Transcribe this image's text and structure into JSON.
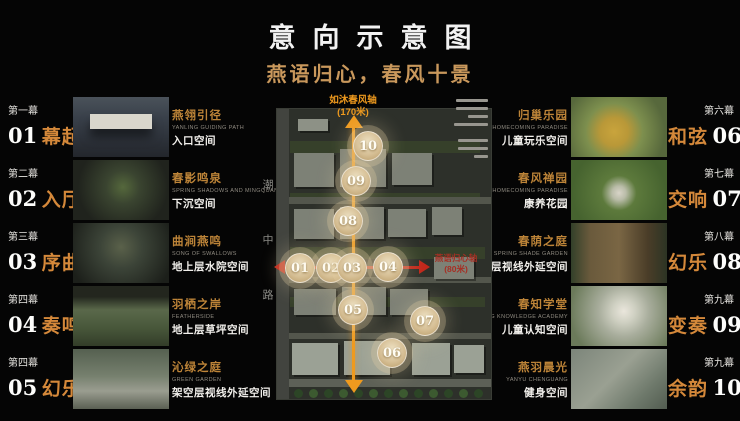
{
  "title": "意向示意图",
  "subtitle": "燕语归心，春风十景",
  "left_items": [
    {
      "act": "第一幕",
      "num": "01",
      "name": "幕起",
      "feature": "燕翎引径",
      "feature_en": "YANLING GUIDING PATH",
      "space": "入口空间"
    },
    {
      "act": "第二幕",
      "num": "02",
      "name": "入厅",
      "feature": "春影鸣泉",
      "feature_en": "SPRING SHADOWS AND MINGQUAN",
      "space": "下沉空间"
    },
    {
      "act": "第三幕",
      "num": "03",
      "name": "序曲",
      "feature": "曲涧燕鸣",
      "feature_en": "SONG OF SWALLOWS",
      "space": "地上层水院空间"
    },
    {
      "act": "第四幕",
      "num": "04",
      "name": "奏鸣",
      "feature": "羽栖之岸",
      "feature_en": "FEATHERSIDE",
      "space": "地上层草坪空间"
    },
    {
      "act": "第四幕",
      "num": "05",
      "name": "幻乐",
      "feature": "沁绿之庭",
      "feature_en": "GREEN GARDEN",
      "space": "架空层视线外延空间"
    }
  ],
  "right_items": [
    {
      "act": "第六幕",
      "num": "06",
      "name": "和弦",
      "feature": "归巢乐园",
      "feature_en": "HOMECOMING PARADISE",
      "space": "儿童玩乐空间"
    },
    {
      "act": "第七幕",
      "num": "07",
      "name": "交响",
      "feature": "春风禅园",
      "feature_en": "HOMECOMING PARADISE",
      "space": "康养花园"
    },
    {
      "act": "第八幕",
      "num": "08",
      "name": "幻乐",
      "feature": "春荫之庭",
      "feature_en": "SPRING SHADE GARDEN",
      "space": "架空层视线外延空间"
    },
    {
      "act": "第九幕",
      "num": "09",
      "name": "变奏",
      "feature": "春知学堂",
      "feature_en": "SPRING KNOWLEDGE ACADEMY",
      "space": "儿童认知空间"
    },
    {
      "act": "第九幕",
      "num": "10",
      "name": "余韵",
      "feature": "燕羽晨光",
      "feature_en": "YANYU CHENGUANG",
      "space": "健身空间"
    }
  ],
  "map": {
    "axis_v_name": "如沐春风轴",
    "axis_v_len": "(170米)",
    "axis_h_name": "燕语归心轴",
    "axis_h_len": "(80米)",
    "road_name": "潮中路",
    "markers": [
      "01",
      "02",
      "03",
      "04",
      "05",
      "06",
      "07",
      "08",
      "09",
      "10"
    ]
  },
  "colors": {
    "background": "#050505",
    "subtitle_gold": "#c9985c",
    "scene_name_orange": "#d4883a",
    "feature_gold": "#bd8438",
    "axis_orange": "#ef9a1e",
    "axis_red": "#c1271b",
    "marker_tan": "#d6bf95"
  }
}
